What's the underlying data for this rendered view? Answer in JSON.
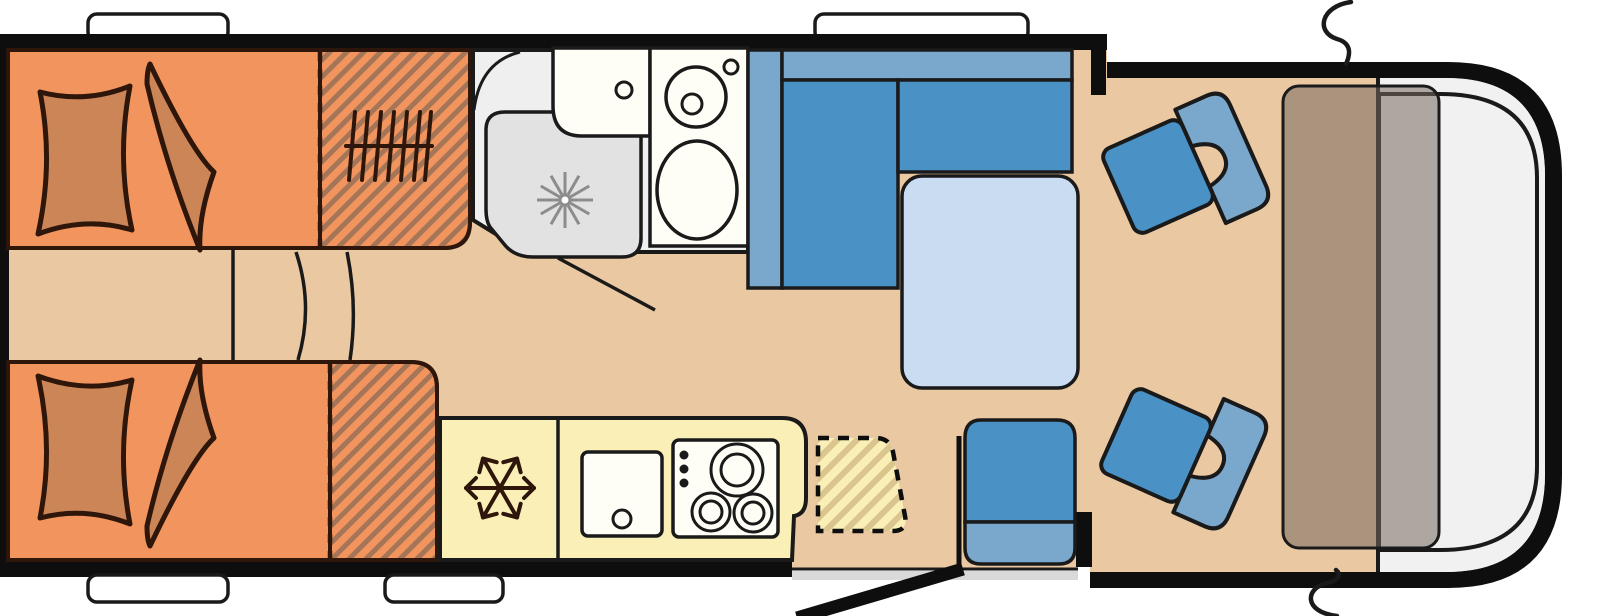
{
  "diagram": {
    "type": "motorhome-floorplan",
    "orientation": "rear-at-left-front-cab-at-right",
    "colors": {
      "wall": "#0E0E0E",
      "outline": "#1A1A1A",
      "bedOutline": "#2E160A",
      "floor": "#EAC8A2",
      "bed": "#F2945E",
      "bedding": "#CB8557",
      "hatchBrown": "#8A6B55",
      "kitchen": "#FAF0B7",
      "hatchYellow": "#D2BA85",
      "fixture": "#FFFEF6",
      "bath": "#EFEFEF",
      "tray": "#E2E2E2",
      "spray": "#8C8C8C",
      "seatDark": "#4A92C5",
      "seatLight": "#7AA7CC",
      "table": "#C9DCF2",
      "windshield": "#F1F1F1",
      "dashboard": "#766A5E",
      "stepGray": "#D9D9D9",
      "window": "#FFFFFF"
    },
    "zones": [
      {
        "id": "single-bed-rear-top",
        "kind": "bed",
        "hatched_extension": true
      },
      {
        "id": "single-bed-rear-bottom",
        "kind": "bed",
        "hatched_extension": true
      },
      {
        "id": "steps-between-beds",
        "kind": "steps"
      },
      {
        "id": "washroom",
        "kind": "bathroom",
        "fixtures": [
          "shower-tray",
          "washbasin",
          "toilet"
        ]
      },
      {
        "id": "kitchen",
        "kind": "kitchen",
        "fixtures": [
          "fridge",
          "sink",
          "hob-3-burner",
          "worktop-flap-dashed"
        ]
      },
      {
        "id": "dinette",
        "kind": "seating",
        "fixtures": [
          "l-shaped-bench",
          "backrest",
          "table"
        ]
      },
      {
        "id": "entrance",
        "kind": "door",
        "fixtures": [
          "entry-step",
          "open-door",
          "cabinet"
        ]
      },
      {
        "id": "cab",
        "kind": "driver-cab",
        "fixtures": [
          "swivel-seat-top",
          "swivel-seat-bottom",
          "dashboard",
          "windshield",
          "wing-mirrors"
        ]
      }
    ],
    "icons": [
      "snowflake-icon",
      "shower-spray-icon",
      "radiator-grille-icon",
      "burner-ring-icon",
      "drain-icon",
      "faucet-icon",
      "wing-mirror-icon",
      "pillow-icon",
      "blanket-icon"
    ],
    "windows": {
      "top": 2,
      "bottom": 2
    }
  }
}
